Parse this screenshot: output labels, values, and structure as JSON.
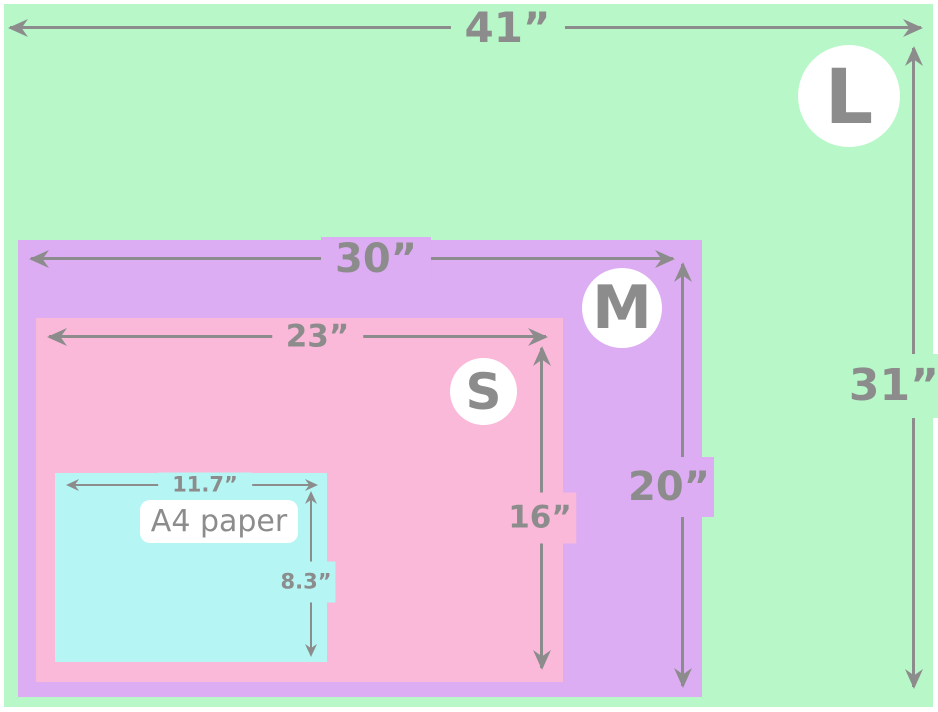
{
  "colors": {
    "l_green": "#b7f7c8",
    "m_purple": "#dcadf2",
    "s_pink": "#fab9d9",
    "a4_cyan": "#b5f5f4",
    "dimension_gray": "#8c8c8c",
    "badge_white": "#ffffff"
  },
  "sizes": {
    "large": {
      "badge": "L",
      "width": "41”",
      "height": "31”"
    },
    "medium": {
      "badge": "M",
      "width": "30”",
      "height": "20”"
    },
    "small": {
      "badge": "S",
      "width": "23”",
      "height": "16”"
    },
    "a4": {
      "label": "A4 paper",
      "width": "11.7”",
      "height": "8.3”"
    }
  }
}
